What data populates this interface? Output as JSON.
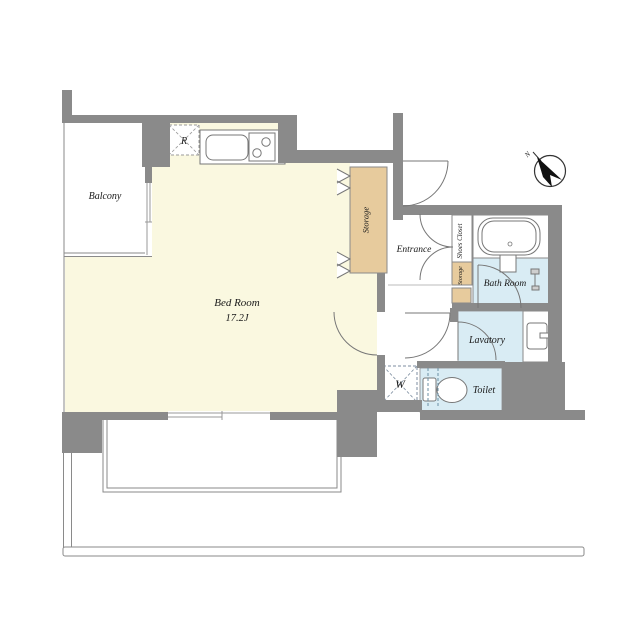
{
  "floorplan": {
    "labels": {
      "balcony": "Balcony",
      "bedroom": "Bed Room",
      "bedroom_size": "17.2J",
      "storage_main": "Storage",
      "entrance": "Entrance",
      "shoes_closet": "Shoes Closet",
      "storage_small": "Storage",
      "bathroom": "Bath Room",
      "lavatory": "Lavatory",
      "toilet": "Toilet",
      "refrigerator_symbol": "R",
      "washer_symbol": "W",
      "north_symbol": "N"
    },
    "colors": {
      "wall": "#8a8a8a",
      "bedroom_floor": "#faf8e0",
      "storage_fill": "#e7cb9d",
      "wet_area_floor": "#d9ecf4",
      "white_floor": "#ffffff"
    }
  }
}
